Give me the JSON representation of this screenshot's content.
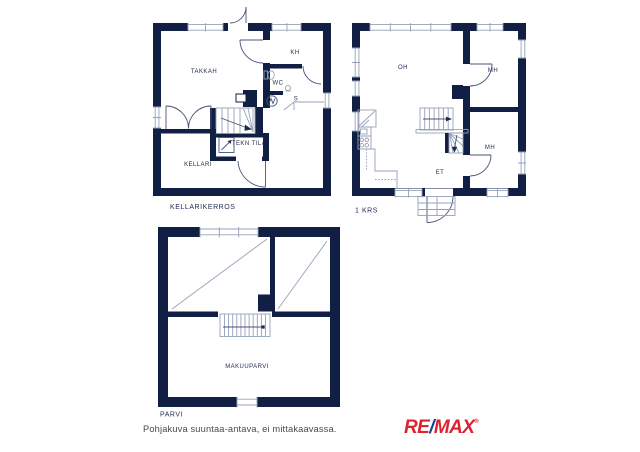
{
  "page": {
    "background": "#ffffff",
    "description": "Real estate floor plan sheet with three storeys"
  },
  "colors": {
    "wall": "#121f45",
    "line-light": "#96a1b8",
    "line-mid": "#46547a",
    "ink": "#1e2a4c",
    "footer-text": "#4a4a4a",
    "remax-red": "#dc2332",
    "remax-blue": "#16408f"
  },
  "plans": {
    "basement": {
      "label": "KELLARIKERROS",
      "rooms": {
        "takkah": "TAKKAH",
        "kh": "KH",
        "wc": "WC",
        "s": "S",
        "tekn_tila": "TEKN TILA",
        "kellari": "KELLARI"
      }
    },
    "first_floor": {
      "label": "1 KRS",
      "rooms": {
        "oh": "OH",
        "mh_top": "MH",
        "mh_bottom": "MH",
        "et": "ET"
      }
    },
    "loft": {
      "label": "PARVI",
      "rooms": {
        "makuuparvi": "MAKUUPARVI"
      }
    }
  },
  "icons": {
    "sauna_heater": "sauna-heater-icon",
    "toilet": "toilet-icon",
    "washbasin": "washbasin-icon",
    "boiler": "boiler-icon",
    "corner_cabinet": "corner-cabinet-icon",
    "sink": "sink-icon",
    "stove": "stove-icon"
  },
  "footer": {
    "disclaimer": "Pohjakuva suuntaa-antava, ei mittakaavassa.",
    "brand": {
      "re": "RE",
      "slash": "/",
      "max": "MAX",
      "registered": "®"
    }
  }
}
